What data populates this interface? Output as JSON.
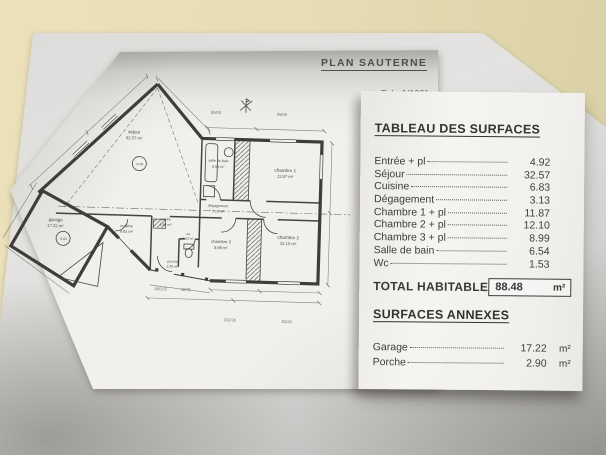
{
  "photo": {
    "background_color": "#e7dcb4",
    "backing_sheet_color": "#dcdbd9",
    "paper_color": "#f1f0ec",
    "ink_color": "#45443f"
  },
  "plan_sheet": {
    "title": "PLAN SAUTERNE",
    "scale": "Ech: 1/100°",
    "rooms": {
      "sejour": {
        "name": "séjour",
        "area": "32.57 m²"
      },
      "salle_de_bain": {
        "name": "salle de bain",
        "area": "6.54 m²"
      },
      "chambre1": {
        "name": "chambre 1",
        "area": "11.87 m²"
      },
      "chambre2": {
        "name": "chambre 2",
        "area": "12.10 m²"
      },
      "chambre3": {
        "name": "chambre 3",
        "area": "8.99 m²"
      },
      "degagement": {
        "name": "dégagement",
        "area": "3.13 m²"
      },
      "entree": {
        "name": "entrée",
        "area": "4.92 m²"
      },
      "cuisine": {
        "name": "cuisine",
        "area": "6.83 m²"
      },
      "wc": {
        "name": "wc",
        "area": "1.53 m²"
      },
      "garage": {
        "name": "garage",
        "area": "17.22 m²"
      },
      "porche": {
        "name": "porche",
        "area": "2.90 m²"
      }
    },
    "levels": {
      "sejour": "+0.00",
      "garage": "-0.03"
    },
    "marks": [
      "80/05",
      "05/08",
      "90/225",
      "40/75",
      "232/28",
      "83/28"
    ]
  },
  "surface_table": {
    "title": "TABLEAU DES SURFACES",
    "rows": [
      {
        "label": "Entrée + pl",
        "value": "4.92"
      },
      {
        "label": "Séjour",
        "value": "32.57"
      },
      {
        "label": "Cuisine",
        "value": "6.83"
      },
      {
        "label": "Dégagement",
        "value": "3.13"
      },
      {
        "label": "Chambre 1 + pl",
        "value": "11.87"
      },
      {
        "label": "Chambre 2 + pl",
        "value": "12.10"
      },
      {
        "label": "Chambre 3 + pl",
        "value": "8.99"
      },
      {
        "label": "Salle de bain",
        "value": "6.54"
      },
      {
        "label": "Wc",
        "value": "1.53"
      }
    ],
    "total_label": "TOTAL HABITABLE",
    "total_value": "88.48",
    "total_unit": "m²",
    "annex_title": "SURFACES ANNEXES",
    "annex_rows": [
      {
        "label": "Garage",
        "value": "17.22",
        "unit": "m²"
      },
      {
        "label": "Porche",
        "value": "2.90",
        "unit": "m²"
      }
    ]
  }
}
